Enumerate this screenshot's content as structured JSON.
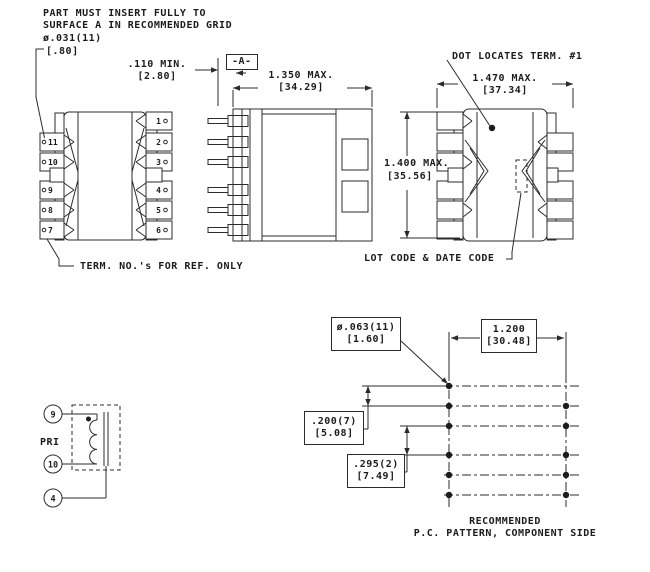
{
  "drawing": {
    "notes": {
      "insert_note_line1": "PART MUST INSERT FULLY TO",
      "insert_note_line2": "SURFACE A IN RECOMMENDED GRID",
      "dot_locates": "DOT LOCATES TERM. #1",
      "term_ref": "TERM. NO.'s FOR REF. ONLY",
      "lot_code": "LOT CODE & DATE CODE",
      "pc_caption_line1": "RECOMMENDED",
      "pc_caption_line2": "P.C. PATTERN, COMPONENT SIDE"
    },
    "dimensions": {
      "hole_top": {
        "value": "ø.031(11)",
        "metric": "[.80]"
      },
      "standoff": {
        "value": ".110 MIN.",
        "metric": "[2.80]"
      },
      "datum": "-A-",
      "width_side": {
        "value": "1.350 MAX.",
        "metric": "[34.29]"
      },
      "width_bottom": {
        "value": "1.470 MAX.",
        "metric": "[37.34]"
      },
      "height_bottom": {
        "value": "1.400 MAX.",
        "metric": "[35.56]"
      },
      "hole_pc": {
        "value": "ø.063(11)",
        "metric": "[1.60]"
      },
      "row_span": {
        "value": "1.200",
        "metric": "[30.48]"
      },
      "pitch": {
        "value": ".200(7)",
        "metric": "[5.08]"
      },
      "gap_pitch": {
        "value": ".295(2)",
        "metric": "[7.49]"
      }
    },
    "top_view": {
      "left_pins": [
        "11",
        "10",
        "9",
        "8",
        "7"
      ],
      "right_pins": [
        "1",
        "2",
        "3",
        "4",
        "5",
        "6"
      ]
    },
    "schematic": {
      "label": "PRI",
      "terminals": [
        "9",
        "10",
        "4"
      ]
    },
    "colors": {
      "line": "#2b2b2b",
      "text": "#1c1c1c",
      "background": "#ffffff"
    }
  }
}
